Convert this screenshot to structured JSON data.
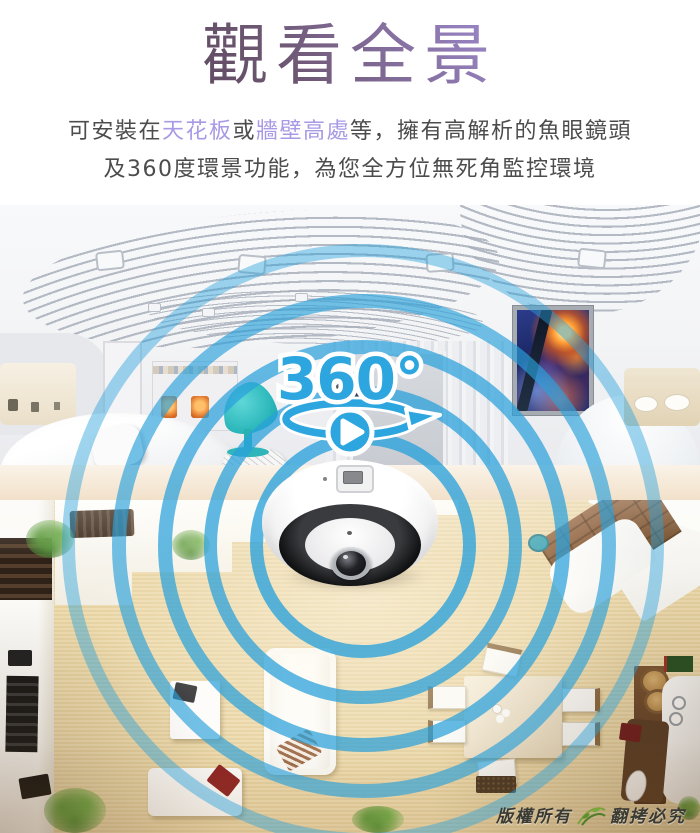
{
  "header": {
    "title": "觀看全景",
    "line1": {
      "p1": "可安裝在",
      "p2": "天花板",
      "p3": "或",
      "p4": "牆壁高處",
      "p5": "等，擁有高解析的魚眼鏡頭"
    },
    "line2": "及360度環景功能，為您全方位無死角監控環境"
  },
  "hero": {
    "badge": "360°",
    "ring_color": "#2aa1db",
    "accent_blue": "#2da6df"
  },
  "footer": {
    "copyright_left": "版權所有",
    "copyright_right": "翻拷必究"
  },
  "colors": {
    "highlight_purple": "#a89ae4",
    "title_gradient_from": "#483747",
    "title_gradient_to": "#bcaaf0",
    "body_text": "#4c4c4c",
    "wood_floor": "#e8d5a8"
  }
}
